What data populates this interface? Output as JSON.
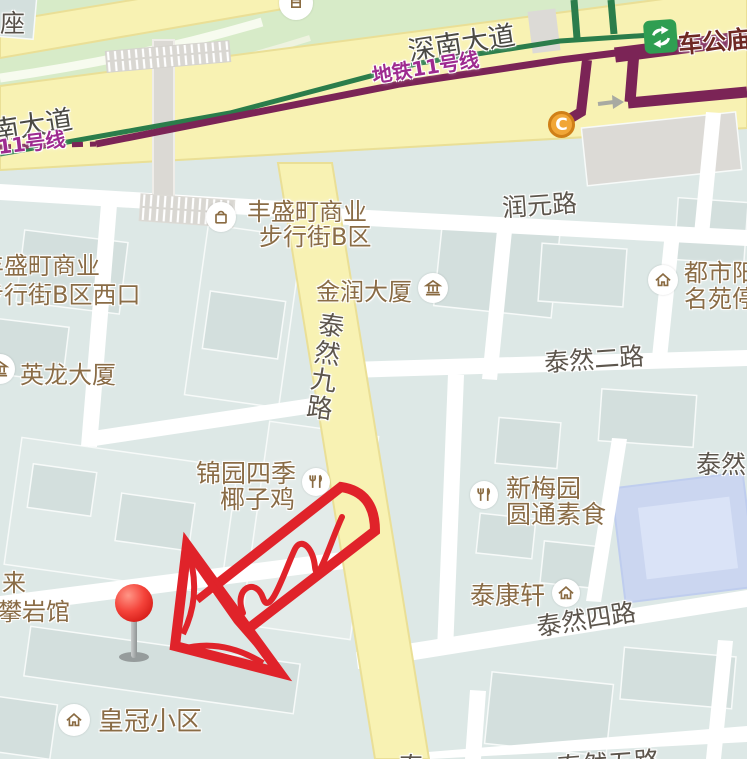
{
  "map": {
    "transit": {
      "station_name": "车公庙",
      "line_label_east": "地铁11号线",
      "line_label_west": "地铁11号线",
      "exit_label": "C"
    },
    "roads": {
      "shennan_east": "深南大道",
      "shennan_west": "南大道",
      "runyuan": "润元路",
      "tairan9": "泰然九路",
      "tairan2": "泰然二路",
      "tairan4": "泰然四路",
      "tairan9_bottom_partial": "泰",
      "tairan5_bottom_partial": "泰然五路",
      "tairan_topright_partial": "泰然"
    },
    "pois": {
      "zuo_partial": "座",
      "fengsheng_b_line1": "丰盛町商业",
      "fengsheng_b_line2": "步行街B区",
      "fengsheng_west_line1": "丰盛町商业",
      "fengsheng_west_line2": "步行街B区西口",
      "jinrun": "金润大厦",
      "yinglong": "英龙大厦",
      "dushi_line1": "都市阳台",
      "dushi_line2": "名苑停车",
      "jinyuan_line1": "锦园四季",
      "jinyuan_line2": "椰子鸡",
      "xinmeiyuan_line1": "新梅园",
      "xinmeiyuan_line2": "圆通素食",
      "taikang": "泰康轩",
      "climbing_line1": "来",
      "climbing_line2": "攀岩馆",
      "huangguan": "皇冠小区"
    },
    "colors": {
      "road_yellow": "#f8f2b3",
      "metro_line_green": "#2b7d4b",
      "metro_line_purple": "#7b2456",
      "metro_label_purple": "#9e2b90",
      "poi_label_brown": "#8a6c46",
      "road_label_gray": "#5d564d",
      "station_label_maroon": "#6e2823",
      "transfer_icon_green": "#2f9e52",
      "exit_marker_orange": "#f1a637",
      "annotation_red": "#e0232a",
      "pin_red": "#e51c15",
      "building_blue": "#cbd6f0"
    }
  }
}
